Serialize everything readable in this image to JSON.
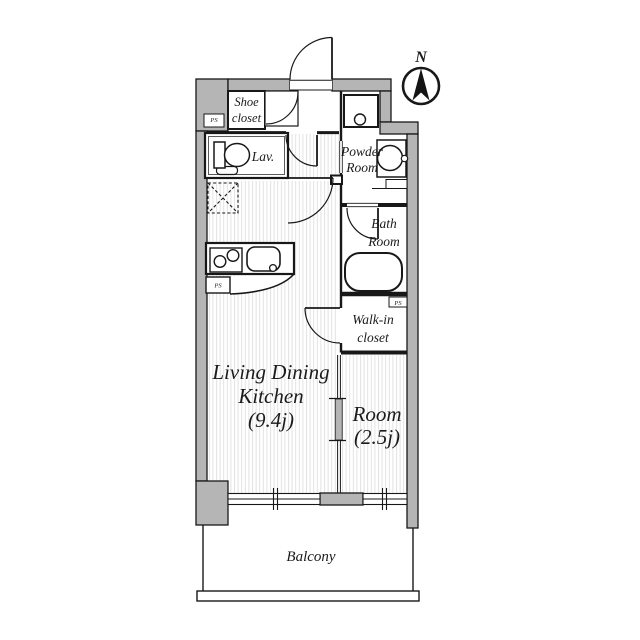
{
  "compass": {
    "north_label": "N"
  },
  "labels": {
    "pipe_shaft": "PS"
  },
  "rooms": {
    "shoe_closet": {
      "line1": "Shoe",
      "line2": "closet"
    },
    "lavatory": {
      "label": "Lav."
    },
    "powder_room": {
      "line1": "Powder",
      "line2": "Room"
    },
    "bath_room": {
      "line1": "Bath",
      "line2": "Room"
    },
    "walk_in_closet": {
      "line1": "Walk-in",
      "line2": "closet"
    },
    "living_dining_kitchen": {
      "line1": "Living Dining",
      "line2": "Kitchen",
      "size": "(9.4j)"
    },
    "room": {
      "line1": "Room",
      "size": "(2.5j)"
    },
    "balcony": {
      "label": "Balcony"
    }
  },
  "colors": {
    "wall_fill": "#b5b5b5",
    "line": "#181818",
    "floor_stripe": "#e2e2e2",
    "background": "#ffffff"
  }
}
